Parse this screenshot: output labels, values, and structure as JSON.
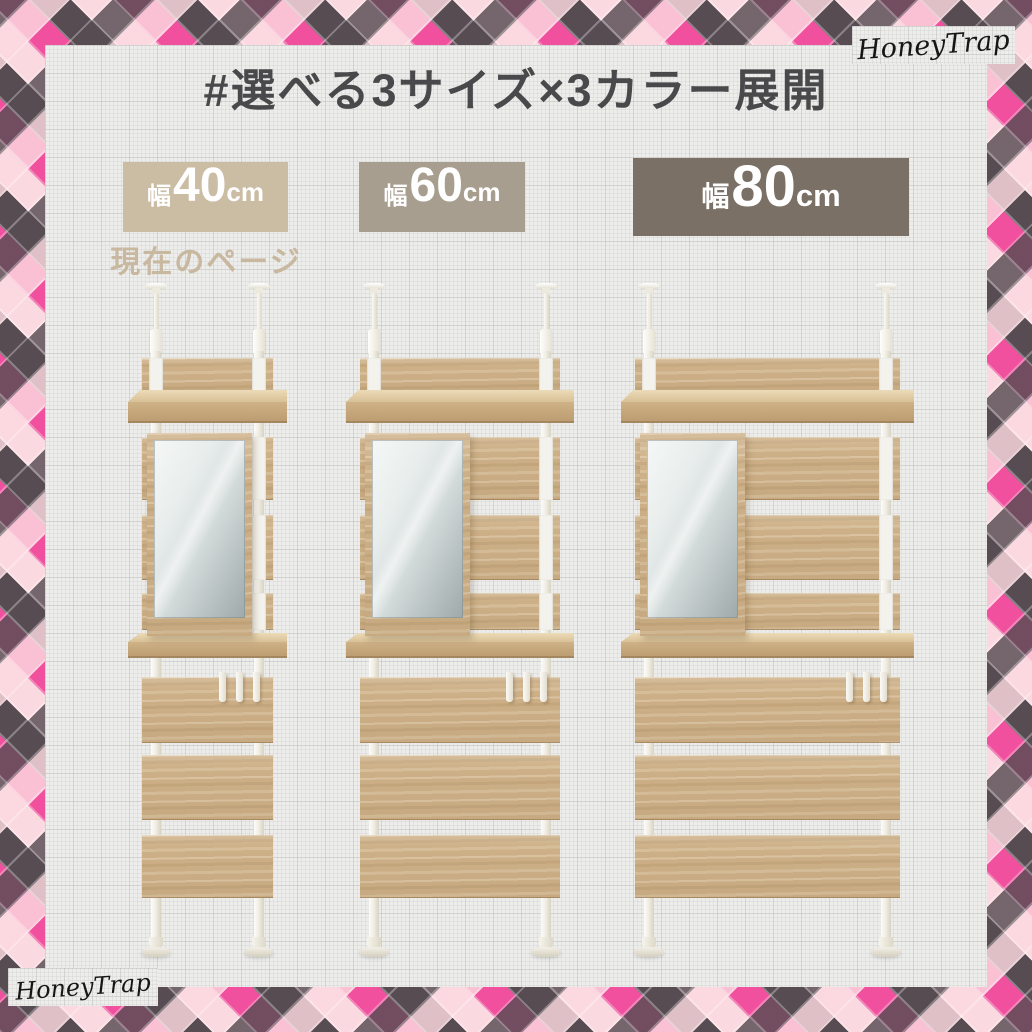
{
  "header": {
    "title": "#選べる3サイズ×3カラー展開"
  },
  "watermarks": {
    "top_right": "HoneyTrap",
    "bottom_left": "HoneyTrap"
  },
  "size_options": [
    {
      "id": "40cm",
      "prefix": "幅",
      "value": "40",
      "unit": "cm",
      "note": "現在のページ",
      "badge_color": "#cbbca4",
      "is_current": true
    },
    {
      "id": "60cm",
      "prefix": "幅",
      "value": "60",
      "unit": "cm",
      "badge_color": "#a89e90",
      "is_current": false
    },
    {
      "id": "80cm",
      "prefix": "幅",
      "value": "80",
      "unit": "cm",
      "badge_color": "#7a7066",
      "is_current": false
    }
  ],
  "palette": {
    "title_text": "#49494b",
    "note_text": "#c8b8a0",
    "paper": "#ededeb",
    "pattern_pink": "#f0509e",
    "pattern_dark": "#574c52",
    "pattern_light_pink": "#fbd9e0",
    "wood": "#cdb087",
    "pole_white": "#f1eee5"
  }
}
